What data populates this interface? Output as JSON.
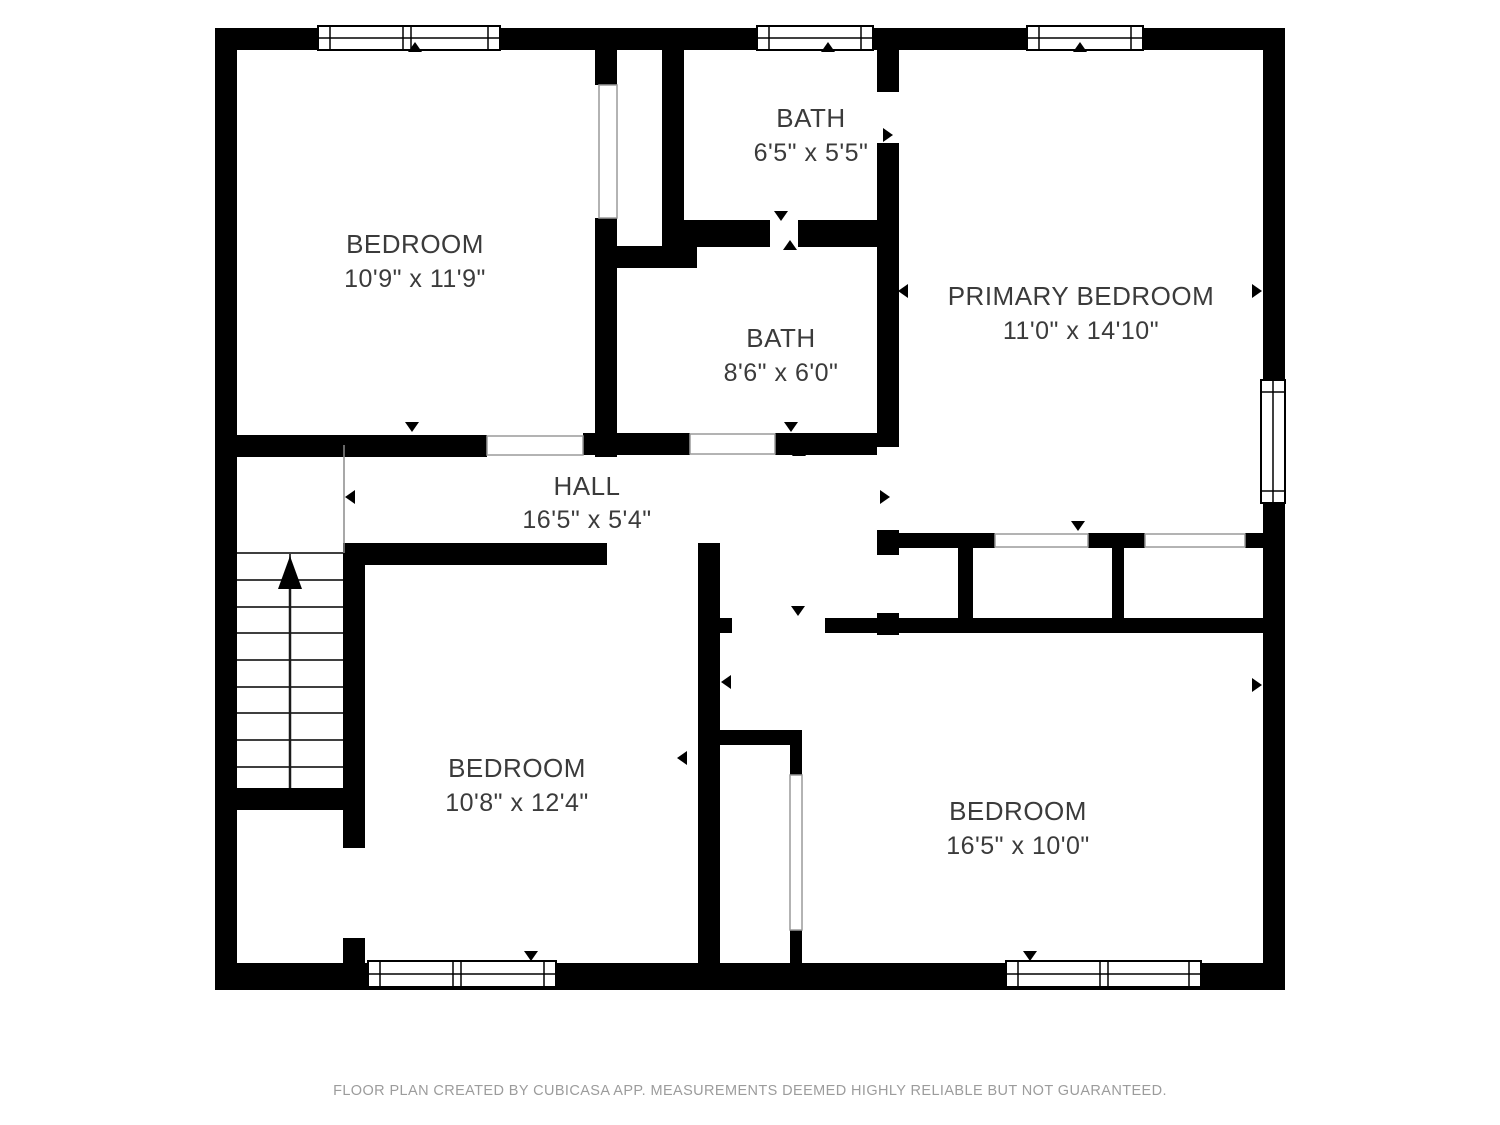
{
  "plan": {
    "title": "Second floor plan",
    "rooms": [
      {
        "id": "bedroom-top-left",
        "name": "BEDROOM",
        "dimensions": "10'9\" x 11'9\""
      },
      {
        "id": "bath-top",
        "name": "BATH",
        "dimensions": "6'5\" x 5'5\""
      },
      {
        "id": "bath-middle",
        "name": "BATH",
        "dimensions": "8'6\" x 6'0\""
      },
      {
        "id": "primary-bedroom",
        "name": "PRIMARY BEDROOM",
        "dimensions": "11'0\" x 14'10\""
      },
      {
        "id": "hall",
        "name": "HALL",
        "dimensions": "16'5\" x 5'4\""
      },
      {
        "id": "bedroom-bottom-left",
        "name": "BEDROOM",
        "dimensions": "10'8\" x 12'4\""
      },
      {
        "id": "bedroom-bottom-right",
        "name": "BEDROOM",
        "dimensions": "16'5\" x 10'0\""
      }
    ],
    "features": {
      "staircase": "stairs up",
      "window_count": 6,
      "closet_count": 4
    },
    "footer": "FLOOR PLAN CREATED BY CUBICASA APP. MEASUREMENTS DEEMED HIGHLY RELIABLE BUT NOT GUARANTEED.",
    "colors": {
      "wall": "#000000",
      "background": "#ffffff",
      "label": "#3b3b3b",
      "footer": "#9c9c9c"
    }
  }
}
